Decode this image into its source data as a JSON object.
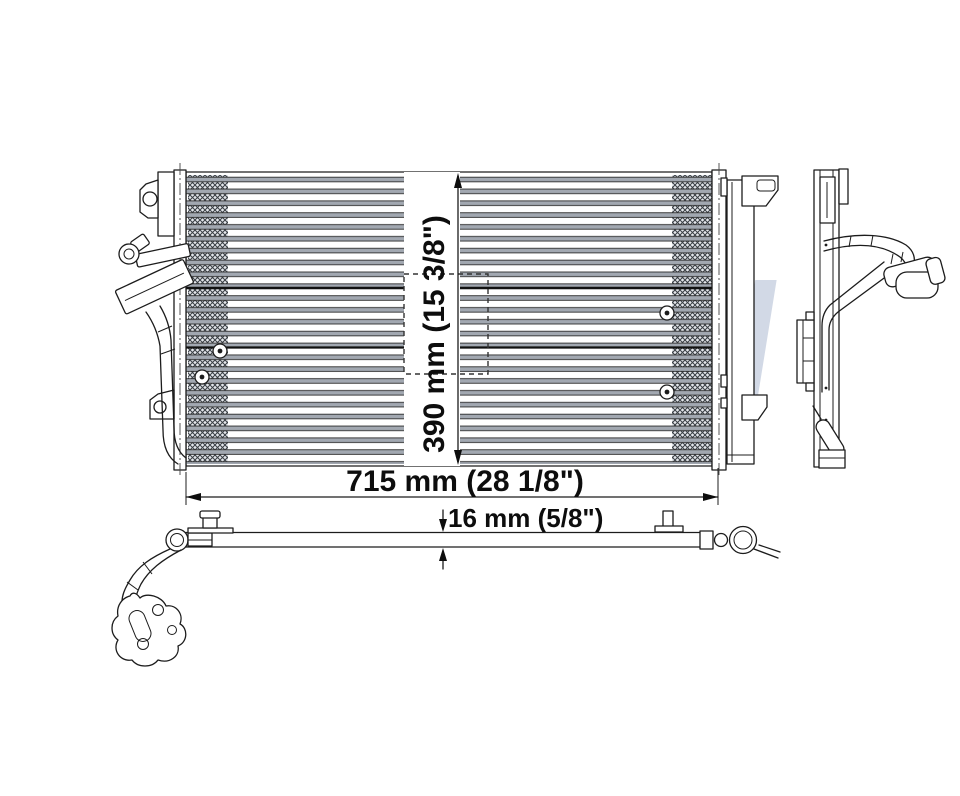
{
  "watermark": {
    "text": "REACH",
    "letter_color": "#aebbd2",
    "swoosh_color": "#d2434e"
  },
  "dimensions": {
    "width": {
      "label": "715 mm (28 1/8\")"
    },
    "height": {
      "label": "390 mm (15 3/8\")"
    },
    "depth": {
      "label": "16 mm (5/8\")"
    }
  },
  "drawing": {
    "line_color": "#1c1c1c",
    "tube_color": "#a2a8b1",
    "fin_color": "#3a3f45",
    "views": [
      "front",
      "side",
      "bottom"
    ]
  }
}
